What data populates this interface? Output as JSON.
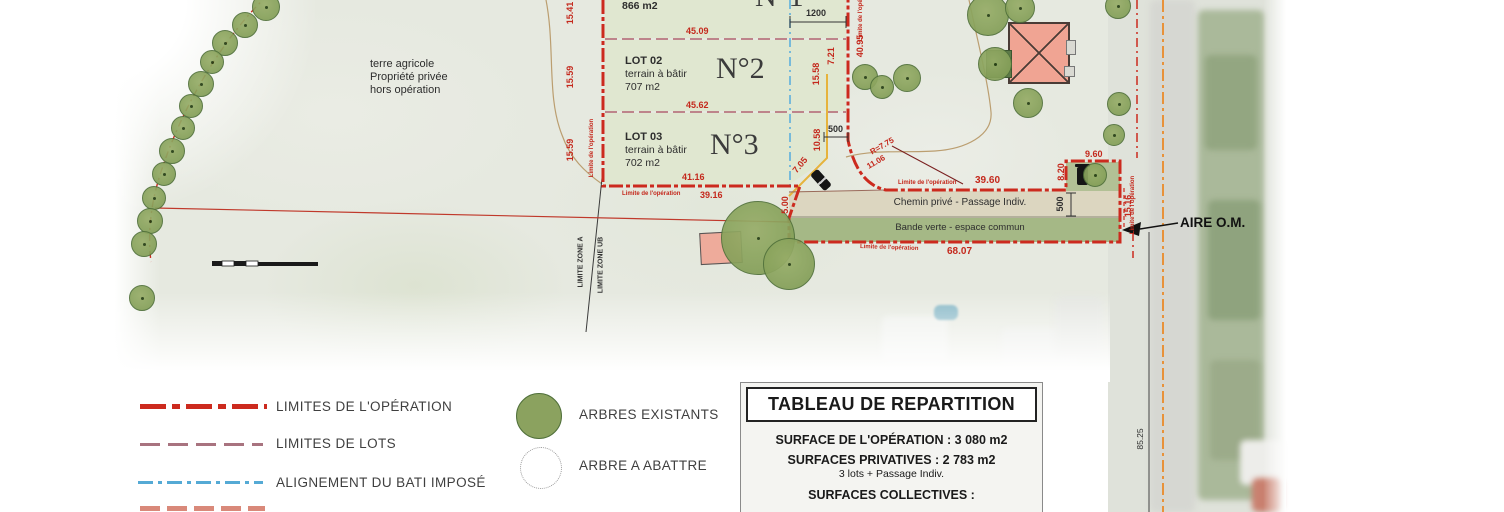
{
  "colors": {
    "operation_limit_red": "#cc2a1e",
    "lot_limit_mauve": "#a8737f",
    "bati_alignment_blue": "#55aad5",
    "road_edge_orange": "#e8923a",
    "tree_green": "#8ba25f",
    "lot_fill": "#e0e7d0",
    "path_fill": "#dcd6c0",
    "green_strip_fill": "#a5b886",
    "building_salmon": "#f0a493"
  },
  "plan": {
    "zone_note": {
      "line1": "terre agricole",
      "line2": "Propriété privée",
      "line3": "hors opération"
    },
    "limite_label": "Limite de l'opération",
    "zone_labels": {
      "zone_a": "LIMITE ZONE A",
      "zone_ub": "LIMITE ZONE UB"
    },
    "lots": {
      "lot1": {
        "area": "866 m2",
        "number": "N°1"
      },
      "lot2": {
        "label": "LOT 02",
        "type": "terrain à bâtir",
        "area": "707 m2",
        "number": "N°2"
      },
      "lot3": {
        "label": "LOT 03",
        "type": "terrain à bâtir",
        "area": "702 m2",
        "number": "N°3"
      }
    },
    "strips": {
      "chemin": "Chemin privé - Passage Indiv.",
      "bande": "Bande verte - espace commun"
    },
    "aire_om": "AIRE O.M.",
    "dims": {
      "lot1_left": "15.41",
      "lot1_width": "45.09",
      "gabarit_top": "1200",
      "lot2_left": "15.59",
      "lot2_right": "15.58",
      "lot2_width": "45.62",
      "right_outer": "40.95",
      "right_upper": "7.21",
      "lot3_left": "15.59",
      "lot3_right": "10.58",
      "gabarit_mid": "500",
      "access_diag": "7.05",
      "lot3_width": "41.16",
      "south_west": "39.16",
      "radius": "R=7.75",
      "curve_len": "11.06",
      "chemin_top": "39.60",
      "chemin_width": "500",
      "aire_west": "8.20",
      "aire_top": "9.60",
      "east": "15.16",
      "south": "68.07",
      "access_west": "5.00",
      "road": "85.25"
    },
    "trees": [
      [
        265,
        6,
        13
      ],
      [
        244,
        24,
        12
      ],
      [
        224,
        42,
        12
      ],
      [
        211,
        61,
        11
      ],
      [
        200,
        83,
        12
      ],
      [
        190,
        105,
        11
      ],
      [
        182,
        127,
        11
      ],
      [
        171,
        150,
        12
      ],
      [
        163,
        173,
        11
      ],
      [
        153,
        197,
        11
      ],
      [
        149,
        220,
        12
      ],
      [
        143,
        243,
        12
      ],
      [
        141,
        297,
        12
      ],
      [
        864,
        76,
        12
      ],
      [
        881,
        86,
        11
      ],
      [
        906,
        77,
        13
      ],
      [
        987,
        14,
        20
      ],
      [
        1019,
        7,
        14
      ],
      [
        994,
        63,
        16
      ],
      [
        1027,
        102,
        14
      ],
      [
        1117,
        5,
        12
      ],
      [
        1118,
        103,
        11
      ],
      [
        1113,
        134,
        10
      ],
      [
        1094,
        174,
        11
      ],
      [
        757,
        237,
        36
      ],
      [
        788,
        263,
        25
      ]
    ]
  },
  "legend": {
    "lines": [
      {
        "label": "LIMITES DE L'OPÉRATION",
        "color": "#cc2a1e",
        "style": "dashdot-thick"
      },
      {
        "label": "LIMITES DE LOTS",
        "color": "#a8737f",
        "style": "dashed"
      },
      {
        "label": "ALIGNEMENT DU BATI IMPOSÉ",
        "color": "#55aad5",
        "style": "dashdot"
      }
    ],
    "symbols": [
      {
        "label": "ARBRES EXISTANTS",
        "symbol": "tree-filled"
      },
      {
        "label": "ARBRE A ABATTRE",
        "symbol": "tree-dotted"
      }
    ]
  },
  "table": {
    "title": "TABLEAU DE REPARTITION",
    "rows": [
      {
        "text": "SURFACE DE L'OPÉRATION : 3 080 m2",
        "bold": true
      },
      {
        "text": "SURFACES PRIVATIVES : 2 783 m2",
        "bold": true
      },
      {
        "text": "3 lots + Passage Indiv.",
        "bold": false
      },
      {
        "text": "SURFACES COLLECTIVES :",
        "bold": true
      }
    ]
  }
}
